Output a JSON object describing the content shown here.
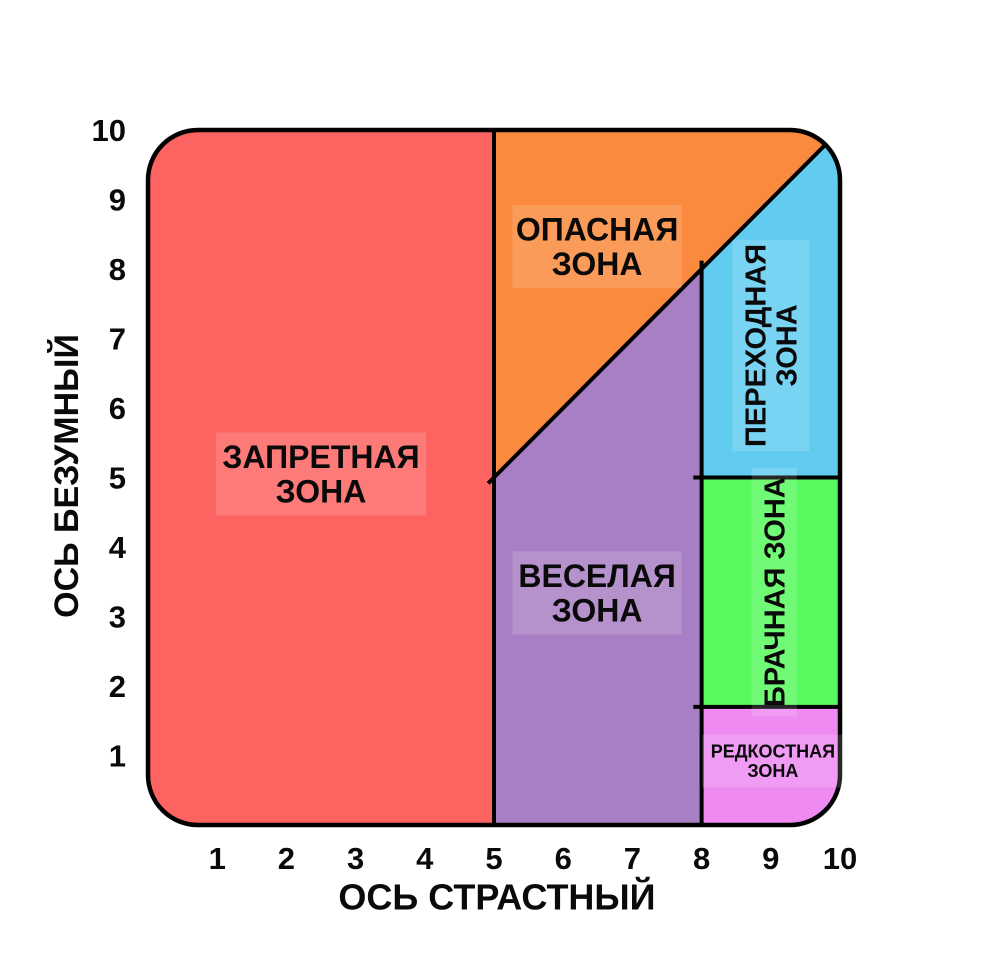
{
  "page": {
    "background": "#ffffff",
    "text_color": "#0a0a0a",
    "line_color": "#000000"
  },
  "chart_data": {
    "type": "area",
    "title": "",
    "xlabel": "ОСЬ СТРАСТНЫЙ",
    "ylabel": "ОСЬ БЕЗУМНЫЙ",
    "xlim": [
      0,
      10
    ],
    "ylim": [
      0,
      10
    ],
    "xticks": [
      "1",
      "2",
      "3",
      "4",
      "5",
      "6",
      "7",
      "8",
      "9",
      "10"
    ],
    "yticks": [
      "1",
      "2",
      "3",
      "4",
      "5",
      "6",
      "7",
      "8",
      "9",
      "10"
    ],
    "grid": false,
    "legend": "none",
    "zones": [
      {
        "id": "forbidden-zone",
        "name": "ЗАПРЕТНАЯ ЗОНА",
        "color": "#FC6361",
        "polygon": [
          [
            0,
            0
          ],
          [
            0,
            10
          ],
          [
            5,
            10
          ],
          [
            5,
            0
          ]
        ],
        "label": {
          "lines": [
            "ЗАПРЕТНАЯ",
            "ЗОНА"
          ],
          "x": 2.5,
          "y": 5.05,
          "rotate": false,
          "size": 32
        }
      },
      {
        "id": "danger-zone",
        "name": "ОПАСНАЯ ЗОНА",
        "color": "#FA8A3E",
        "polygon": [
          [
            5,
            5
          ],
          [
            5,
            10
          ],
          [
            10,
            10
          ]
        ],
        "label": {
          "lines": [
            "ОПАСНАЯ",
            "ЗОНА"
          ],
          "x": 6.49,
          "y": 8.32,
          "rotate": false,
          "size": 32
        }
      },
      {
        "id": "fun-zone",
        "name": "ВЕСЕЛАЯ ЗОНА",
        "color": "#A87FC4",
        "polygon": [
          [
            5,
            0
          ],
          [
            5,
            5
          ],
          [
            8,
            8
          ],
          [
            8,
            0
          ]
        ],
        "label": {
          "lines": [
            "ВЕСЕЛАЯ",
            "ЗОНА"
          ],
          "x": 6.49,
          "y": 3.34,
          "rotate": false,
          "size": 32
        }
      },
      {
        "id": "transition-zone",
        "name": "ПЕРЕХОДНАЯ ЗОНА",
        "color": "#62CCF0",
        "polygon": [
          [
            8,
            5
          ],
          [
            8,
            8
          ],
          [
            10,
            10
          ],
          [
            10,
            5
          ]
        ],
        "label": {
          "lines": [
            "ПЕРЕХОДНАЯ",
            "ЗОНА"
          ],
          "x": 9.0,
          "y": 6.9,
          "rotate": true,
          "size": 29
        }
      },
      {
        "id": "marriage-zone",
        "name": "БРАЧНАЯ ЗОНА",
        "color": "#57FA5E",
        "polygon": [
          [
            8,
            1.7
          ],
          [
            8,
            5
          ],
          [
            10,
            5
          ],
          [
            10,
            1.7
          ]
        ],
        "label": {
          "lines": [
            "БРАЧНАЯ ЗОНА"
          ],
          "x": 9.05,
          "y": 3.35,
          "rotate": true,
          "size": 29
        }
      },
      {
        "id": "unicorn-zone",
        "name": "РЕДКОСТНАЯ ЗОНА",
        "color": "#EE8AF2",
        "polygon": [
          [
            8,
            0
          ],
          [
            8,
            1.7
          ],
          [
            10,
            1.7
          ],
          [
            10,
            0
          ]
        ],
        "label": {
          "lines": [
            "РЕДКОСТНАЯ",
            "ЗОНА"
          ],
          "x": 9.03,
          "y": 0.92,
          "rotate": false,
          "size": 18
        }
      }
    ],
    "boundary_lines": [
      [
        5,
        0,
        5,
        10
      ],
      [
        8,
        0,
        8,
        8
      ],
      [
        5,
        5,
        10,
        10
      ],
      [
        8,
        5,
        10,
        5
      ],
      [
        8,
        1.7,
        10,
        1.7
      ]
    ]
  }
}
